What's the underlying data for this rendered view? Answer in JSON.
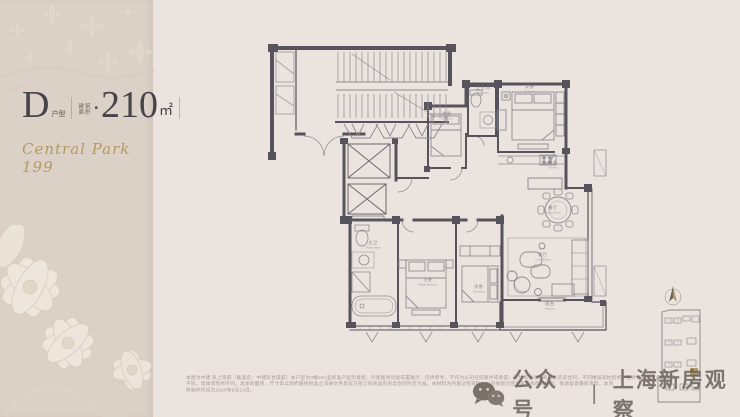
{
  "colors": {
    "page_bg": "#ebe3dd",
    "panel_bg": "#dcd1c7",
    "accent_gold": "#b49a62",
    "wall_color": "#57535c",
    "thin_line_color": "#8f8b95",
    "keyplan_highlight": "#b49a62",
    "watermark_color": "#645d56"
  },
  "left_panel": {
    "unit_label": "D",
    "unit_suffix": "户型",
    "area_label_top": "建筑",
    "area_label_bottom": "面积",
    "bullet": "•",
    "area_value": "210",
    "area_unit": "㎡",
    "project_name": "Central Park 199"
  },
  "floorplan": {
    "rooms": [
      {
        "cn": "次卧",
        "en": "Bedroom"
      },
      {
        "cn": "卫生间",
        "en": "Bathroom"
      },
      {
        "cn": "次卧",
        "en": "Bedroom"
      },
      {
        "cn": "厨房",
        "en": "Kitchen"
      },
      {
        "cn": "餐厅",
        "en": "Dining Room"
      },
      {
        "cn": "客厅",
        "en": "Living Room"
      },
      {
        "cn": "阳台",
        "en": "Balcony"
      },
      {
        "cn": "主卧",
        "en": "Master Bedroom"
      },
      {
        "cn": "次卧",
        "en": "Bedroom"
      },
      {
        "cn": "主卫",
        "en": "Master Bath"
      }
    ]
  },
  "footer": {
    "disclaimer_lines": [
      "本图为中建 玖上琅庭（备案名：中建玖合璟庭）本户型为3幢201室标准户型示意图，示意图为功能布置展示，仅供参考，不作为公司任何要约或承诺，交付标准详见商品房买卖合同，不同楼层梁柱结构、管井等与本示意图或有",
      "不同，墙体或有所不同。具体的面积、尺寸等以政府最终批准之法律文件及双方签订的商品房买卖合同约定为准。本材料为内容过程资料，公司保留对宣传资料修改的权利，敬请留意最新资料。本资",
      "料制作时间为2020年5月14日。"
    ],
    "watermark": {
      "account_label": "公众号",
      "separator": "丨",
      "account_name": "上海新房观察"
    }
  }
}
